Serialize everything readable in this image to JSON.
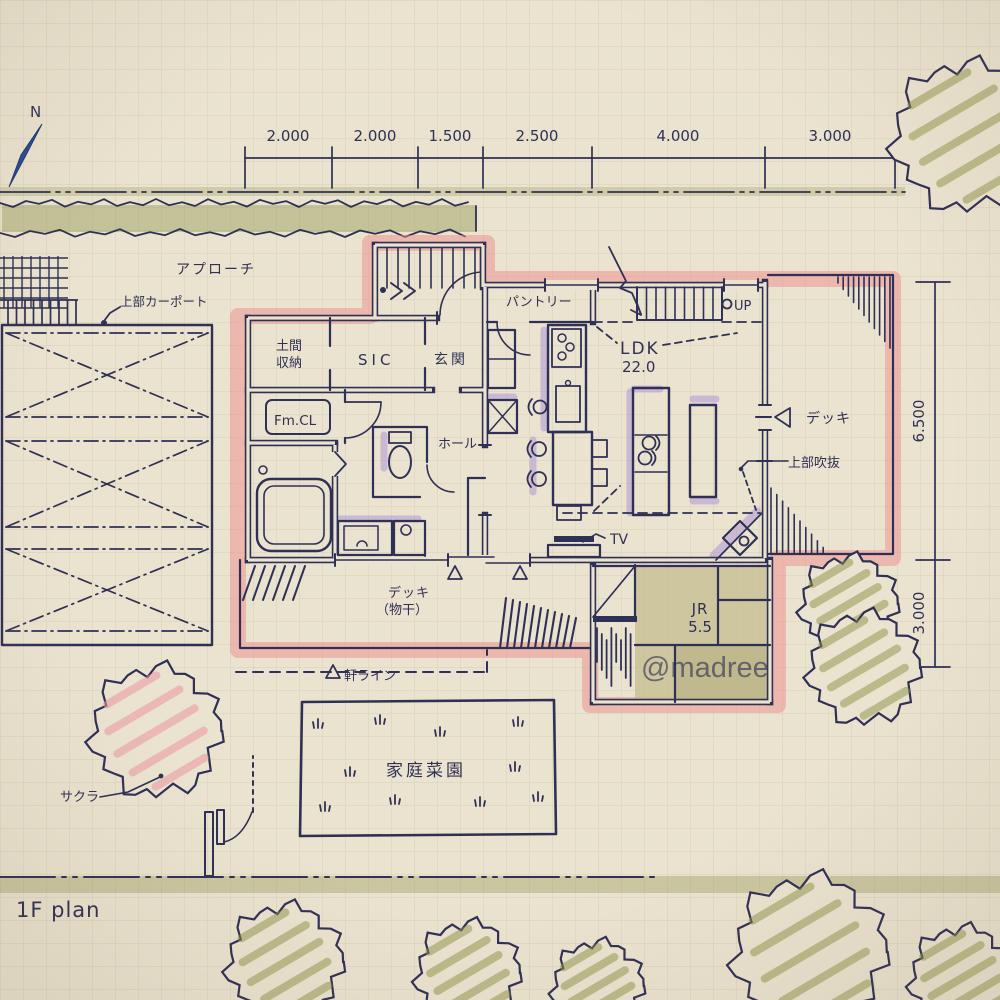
{
  "plan": {
    "north": "N",
    "title": "1F plan",
    "watermark": "@madree",
    "dims_top": [
      "2.000",
      "2.000",
      "1.500",
      "2.500",
      "4.000",
      "3.000"
    ],
    "dims_right": [
      "6.500",
      "3.000"
    ],
    "labels": {
      "approach": "アプローチ",
      "carport": "上部カーポート",
      "pantry": "パントリー",
      "up": "UP",
      "ldk": "LDK",
      "ldk_area": "22.0",
      "doma1": "土間",
      "doma2": "収納",
      "sic": "SIC",
      "genkan": "玄関",
      "fmcl": "Fm.CL",
      "hall": "ホール",
      "deck": "デッキ",
      "void_above": "上部吹抜",
      "tv": "TV",
      "deck_laundry": "デッキ",
      "deck_laundry_sub": "（物干）",
      "eave_line": "軒ライン",
      "jr": "JR",
      "jr_area": "5.5",
      "garden": "家庭菜園",
      "sakura": "サクラ"
    },
    "colors": {
      "paper": "#eae3cf",
      "ink": "#2f3055",
      "pink_marker": "#ee8c8c",
      "purple_marker": "#b3a0d8",
      "blue_marker": "#7fa8dc",
      "olive_marker": "#969b55",
      "wood_tan": "#d2bc8f",
      "tatami": "#ccc5a0"
    }
  }
}
